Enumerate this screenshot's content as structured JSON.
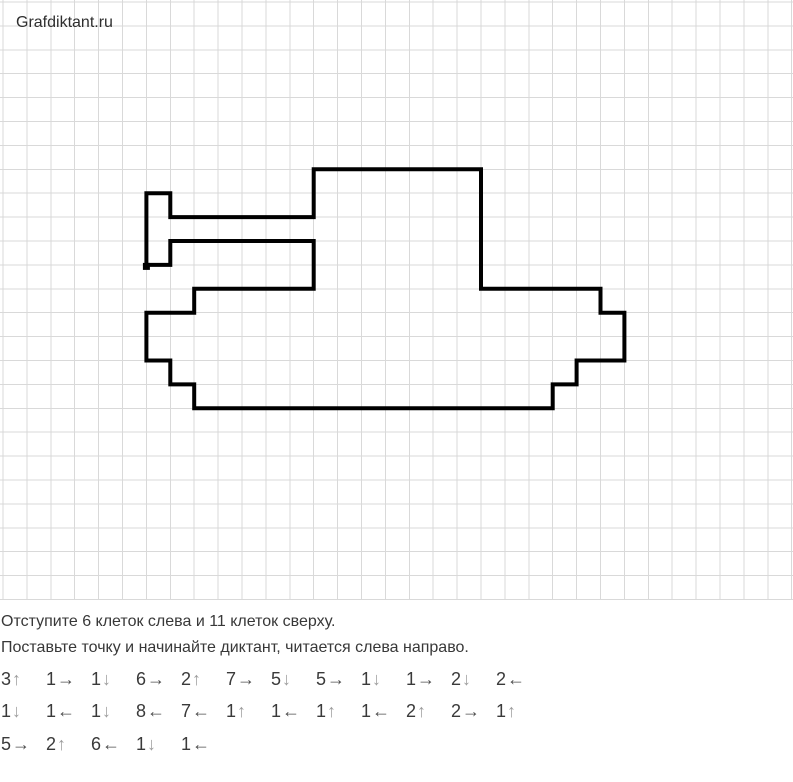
{
  "header": {
    "site": "Grafdiktant.ru"
  },
  "instructions": {
    "line1": "Отступите 6 клеток слева и 11 клеток сверху.",
    "line2": "Поставьте точку и начинайте диктант, читается слева направо."
  },
  "grid": {
    "cell_px": 23.9,
    "origin_x": 3,
    "origin_y": 2,
    "cols": 33,
    "rows": 25,
    "line_color": "#d9d9d9",
    "background": "#ffffff"
  },
  "figure": {
    "stroke_color": "#000000",
    "stroke_width": 4,
    "start_cell": {
      "col": 6,
      "row": 11
    },
    "start_dot_px": 7
  },
  "dictation": {
    "offset_left_cells": 6,
    "offset_top_cells": 11,
    "arrow_glyphs": {
      "up": "↑",
      "down": "↓",
      "left": "←",
      "right": "→"
    },
    "rows": [
      [
        {
          "n": "3",
          "d": "up"
        },
        {
          "n": "1",
          "d": "right"
        },
        {
          "n": "1",
          "d": "down"
        },
        {
          "n": "6",
          "d": "right"
        },
        {
          "n": "2",
          "d": "up"
        },
        {
          "n": "7",
          "d": "right"
        },
        {
          "n": "5",
          "d": "down"
        },
        {
          "n": "5",
          "d": "right"
        },
        {
          "n": "1",
          "d": "down"
        },
        {
          "n": "1",
          "d": "right"
        },
        {
          "n": "2",
          "d": "down"
        },
        {
          "n": "2",
          "d": "left"
        }
      ],
      [
        {
          "n": "1",
          "d": "down"
        },
        {
          "n": "1",
          "d": "left"
        },
        {
          "n": "1",
          "d": "down"
        },
        {
          "n": "8",
          "d": "left"
        },
        {
          "n": "7",
          "d": "left"
        },
        {
          "n": "1",
          "d": "up"
        },
        {
          "n": "1",
          "d": "left"
        },
        {
          "n": "1",
          "d": "up"
        },
        {
          "n": "1",
          "d": "left"
        },
        {
          "n": "2",
          "d": "up"
        },
        {
          "n": "2",
          "d": "right"
        },
        {
          "n": "1",
          "d": "up"
        }
      ],
      [
        {
          "n": "5",
          "d": "right"
        },
        {
          "n": "2",
          "d": "up"
        },
        {
          "n": "6",
          "d": "left"
        },
        {
          "n": "1",
          "d": "down"
        },
        {
          "n": "1",
          "d": "left"
        }
      ]
    ]
  }
}
